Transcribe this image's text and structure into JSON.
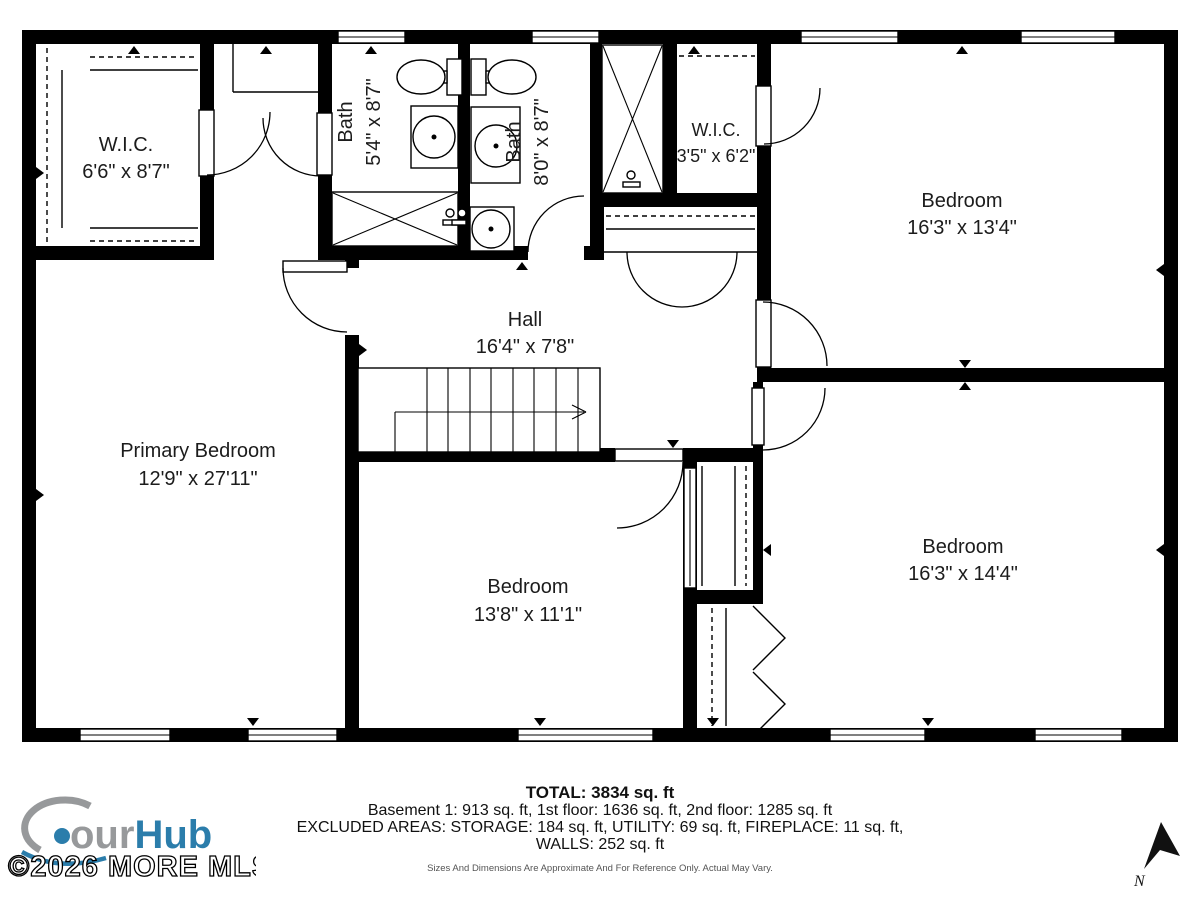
{
  "rooms": {
    "wic_primary": {
      "name": "W.I.C.",
      "dims": "6'6\" x 8'7\""
    },
    "bath_primary": {
      "name": "Bath",
      "dims": "5'4\" x 8'7\""
    },
    "bath_hall": {
      "name": "Bath",
      "dims": "8'0\" x 8'7\""
    },
    "wic_small": {
      "name": "W.I.C.",
      "dims": "3'5\" x 6'2\""
    },
    "bedroom_top_right": {
      "name": "Bedroom",
      "dims": "16'3\" x 13'4\""
    },
    "hall": {
      "name": "Hall",
      "dims": "16'4\" x 7'8\""
    },
    "primary_bedroom": {
      "name": "Primary Bedroom",
      "dims": "12'9\" x 27'11\""
    },
    "bedroom_bottom_mid": {
      "name": "Bedroom",
      "dims": "13'8\" x 11'1\""
    },
    "bedroom_bottom_right": {
      "name": "Bedroom",
      "dims": "16'3\" x 14'4\""
    }
  },
  "footer": {
    "total": "TOTAL: 3834 sq. ft",
    "floors": "Basement 1: 913 sq. ft, 1st floor: 1636 sq. ft, 2nd floor: 1285 sq. ft",
    "excluded": "EXCLUDED AREAS: STORAGE: 184 sq. ft, UTILITY: 69 sq. ft, FIREPLACE: 11 sq. ft,",
    "walls": "WALLS: 252 sq. ft",
    "disclaimer": "Sizes And Dimensions Are Approximate And For Reference Only. Actual May Vary."
  },
  "branding": {
    "logo_tour": "our",
    "logo_hub": "Hub",
    "watermark": "©2026 MORE MLS"
  },
  "compass": {
    "north_label": "N"
  },
  "colors": {
    "wall": "#000000",
    "accent_blue": "#2b7dab",
    "logo_gray": "#97999b"
  }
}
